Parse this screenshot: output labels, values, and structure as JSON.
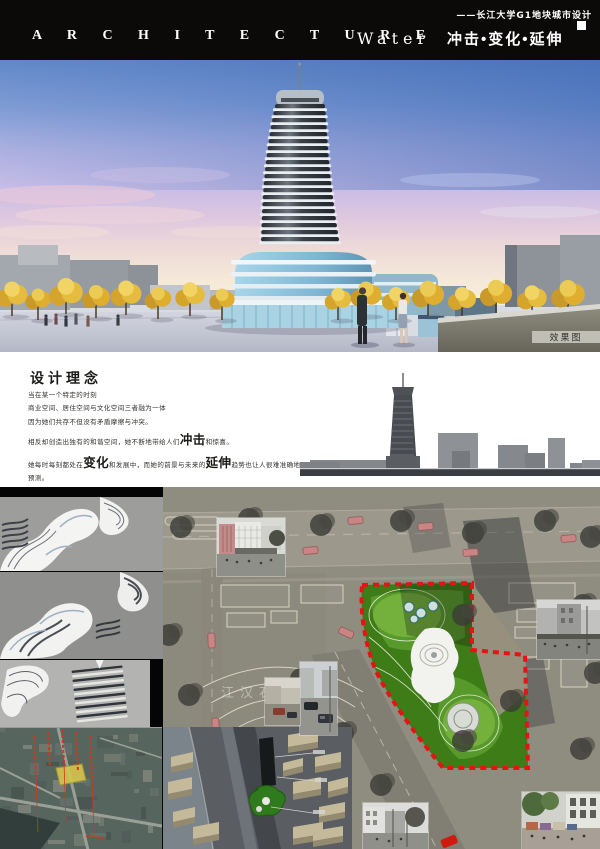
{
  "header": {
    "subtitle": "——长江大学G1地块城市设计",
    "architecture": "A R C H I T E C T U R E",
    "water": "Water",
    "slogan": "冲击•变化•延伸"
  },
  "render": {
    "caption": "效果图"
  },
  "concept": {
    "title": "设计理念",
    "lines": [
      {
        "segments": [
          {
            "t": "当在某一个特定的时刻"
          }
        ]
      },
      {
        "segments": [
          {
            "t": "商业空间、居住空间与文化空间三者融为一体"
          }
        ]
      },
      {
        "segments": [
          {
            "t": "因为她们共存不但没有矛盾摩擦与冲突。"
          }
        ]
      },
      {
        "segments": [
          {
            "t": "相反却创造出独有的和谐空间，她不断地带给人们"
          },
          {
            "t": "冲击",
            "big": true
          },
          {
            "t": "和惊喜。"
          }
        ]
      },
      {
        "segments": [
          {
            "t": "她每时每刻都处在"
          },
          {
            "t": "变化",
            "big": true
          },
          {
            "t": "和发展中，而她的前景与未来的"
          },
          {
            "t": "延伸",
            "big": true
          },
          {
            "t": "趋势也让人很难准确地预测。"
          }
        ]
      },
      {
        "segments": [
          {
            "t": "所以她就是一种艺术形态空间，使办公空间、居住空间与文化空间完美的融合"
          }
        ]
      },
      {
        "segments": [
          {
            "t": "她就是—"
          },
          {
            "t": "“Water”",
            "water": true
          }
        ]
      }
    ]
  },
  "map": {
    "street_label": "江汉石"
  },
  "colors": {
    "header_black": "#0c0a09",
    "boundary_red": "#e41414",
    "site_green": "#3e7c18",
    "tree_gold": "#e0b53a",
    "podium_blue": "#8fc3dc",
    "sky_top": "#6288c8"
  }
}
